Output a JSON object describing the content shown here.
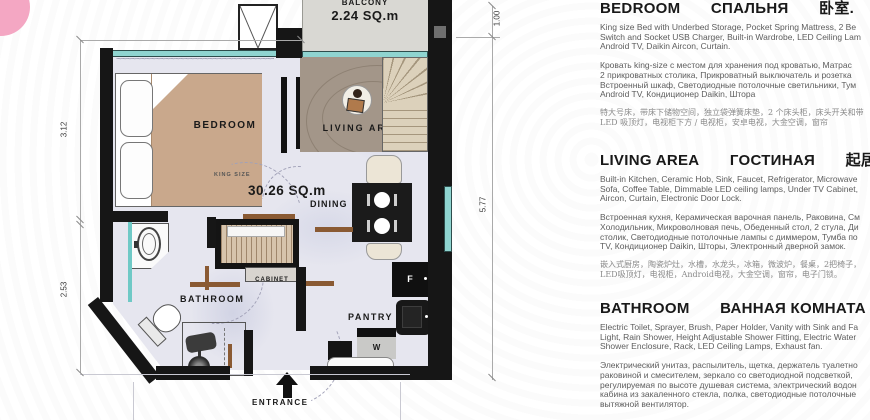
{
  "brand": {
    "accent_color": "#f4a7c3"
  },
  "plan": {
    "labels": {
      "balcony": "BALCONY",
      "balcony_area": "2.24 SQ.m",
      "bedroom": "BEDROOM",
      "king_size": "KING SIZE",
      "living_area": "LIVING AREA",
      "total_area": "30.26 SQ.m",
      "dining": "DINING",
      "cabinet": "CABINET",
      "bathroom": "BATHROOM",
      "pantry": "PANTRY",
      "fridge": "F",
      "washer": "W",
      "entrance": "ENTRANCE"
    },
    "dimensions": {
      "balcony_depth": "1.00",
      "right_height": "5.77",
      "left_upper": "3.12",
      "left_lower": "2.53"
    },
    "colors": {
      "wall": "#161616",
      "window": "#8fd4d0",
      "bed_blanket": "#c9a88c",
      "rug": "#a39689",
      "stairs": "#d9cdb6",
      "floor": "#e6e6ef",
      "door": "#8a5a33"
    }
  },
  "sections": [
    {
      "id": "bedroom",
      "heading": {
        "en": "BEDROOM",
        "ru": "СПАЛЬНЯ",
        "zh": "卧室."
      },
      "en_lines": [
        "King size Bed with Underbed Storage, Pocket Spring Mattress, 2 Be",
        "Switch and Socket USB Charger, Built-in Wardrobe, LED Ceiling Lam",
        "Android TV, Daikin Aircon, Curtain."
      ],
      "ru_lines": [
        "Кровать king-size с местом для хранения под кроватью, Матрас",
        "2 прикроватных столика, Прикроватный выключатель и розетка",
        "Встроенный шкаф, Светодиодные потолочные светильники, Тум",
        "Android TV, Кондиционер Daikin, Штора"
      ],
      "zh_lines": [
        "特大号床，带床下储物空间，独立袋弹簧床垫，2 个床头柜，床头开关和带",
        "LED 吸顶灯，电视柜下方 / 电视柜，安卓电视，大金空调，窗帘"
      ]
    },
    {
      "id": "living-area",
      "heading": {
        "en": "LIVING AREA",
        "ru": "ГОСТИНАЯ",
        "zh": "起居区"
      },
      "en_lines": [
        "Built-in Kitchen, Ceramic Hob, Sink, Faucet, Refrigerator, Microwave",
        "Sofa, Coffee Table, Dimmable LED ceiling lamps, Under TV Cabinet,",
        "Aircon, Curtain, Electronic Door Lock."
      ],
      "ru_lines": [
        "Встроенная кухня, Керамическая варочная панель, Раковина, См",
        "Холодильник, Микроволновая печь, Обеденный стол, 2 стула, Ди",
        "столик, Светодиодные потолочные лампы с диммером, Тумба по",
        "TV, Кондиционер Daikin, Шторы, Электронный дверной замок."
      ],
      "zh_lines": [
        "嵌入式厨房，陶瓷炉灶，水槽，水龙头，冰箱，微波炉，餐桌，2把椅子，",
        "LED吸顶灯，电视柜，Android电视，大金空调，窗帘，电子门锁。"
      ]
    },
    {
      "id": "bathroom",
      "heading": {
        "en": "BATHROOM",
        "ru": "ВАННАЯ КОМНАТА",
        "zh": "浴室"
      },
      "en_lines": [
        "Electric Toilet, Sprayer, Brush, Paper Holder, Vanity with Sink and Fa",
        "Light, Rain Shower, Height Adjustable Shower Fitting, Electric Water",
        "Shower Enclosure, Rack, LED Ceiling Lamps, Exhaust fan."
      ],
      "ru_lines": [
        "Электрический унитаз, распылитель, щетка, держатель туалетно",
        "раковиной и смесителем, зеркало со светодиодной подсветкой,",
        "регулируемая по высоте душевая система, электрический водон",
        "кабина из закаленного стекла, полка, светодиодные потолочные",
        "вытяжной вентилятор."
      ],
      "zh_lines": []
    }
  ]
}
